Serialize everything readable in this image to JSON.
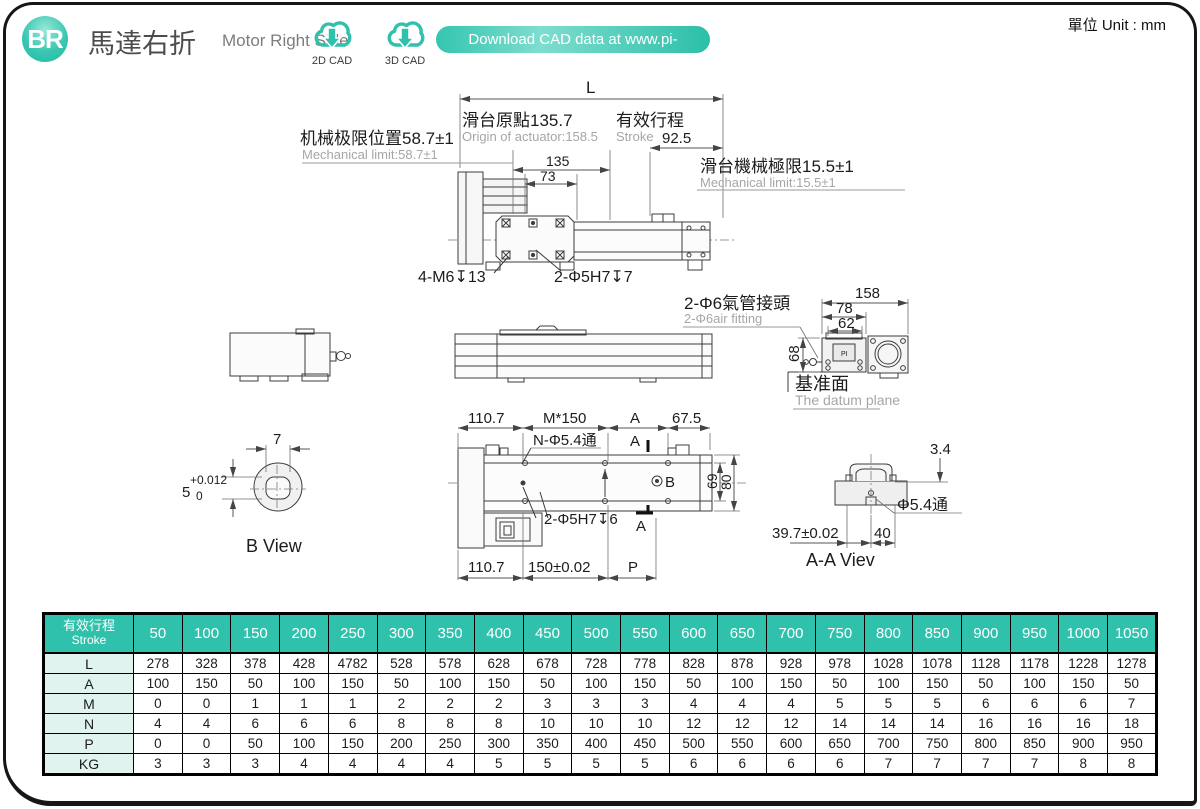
{
  "page": {
    "unit_label": "單位 Unit : mm"
  },
  "header": {
    "logo": "BR",
    "title_zh": "馬達右折",
    "title_en": "Motor Right Side",
    "cad_2d_label": "2D CAD",
    "cad_3d_label": "3D CAD",
    "download_label": "Download CAD data at www.pi-robot.com.cn"
  },
  "colors": {
    "brand_teal": "#2fc1ab",
    "table_label_bg": "#e0f3ef",
    "gray_text": "#a6a6a6"
  },
  "drawing": {
    "top": {
      "L": "L",
      "origin_zh": "滑台原點135.7",
      "origin_en": "Origin of actuator:158.5",
      "stroke_zh": "有效行程",
      "stroke_en": "Stroke",
      "stroke_val": "92.5",
      "lim_left_zh": "机械极限位置58.7±1",
      "lim_left_en": "Mechanical limit:58.7±1",
      "lim_right_zh": "滑台機械極限15.5±1",
      "lim_right_en": "Mechanical limit:15.5±1",
      "d135": "135",
      "d73": "73",
      "bolt": "4-M6↧13",
      "pin": "2-Φ5H7↧7"
    },
    "end": {
      "d158": "158",
      "d78": "78",
      "d62": "62",
      "d68": "68",
      "air_zh": "2-Φ6氣管接頭",
      "air_en": "2-Φ6air fitting",
      "datum_zh": "基准面",
      "datum_en": "The datum plane",
      "pi": "PI"
    },
    "bottom": {
      "d110a": "110.7",
      "dM": "M*150",
      "dA": "A",
      "d675": "67.5",
      "holes": "N-Φ5.4通",
      "secA_top": "A",
      "secA_bot": "A",
      "B": "B",
      "d69": "69",
      "d80": "80",
      "pin6": "2-Φ5H7↧6",
      "d110b": "110.7",
      "d150": "150±0.02",
      "dP": "P"
    },
    "bview": {
      "d7": "7",
      "d5": "5",
      "tol1": "+0.012",
      "tol2": "0",
      "cap": "B View"
    },
    "aaview": {
      "d34": "3.4",
      "phi": "Φ5.4通",
      "d397": "39.7±0.02",
      "d40": "40",
      "cap": "A-A Viev"
    }
  },
  "table": {
    "header_zh": "有效行程",
    "header_en": "Stroke",
    "strokes": [
      "50",
      "100",
      "150",
      "200",
      "250",
      "300",
      "350",
      "400",
      "450",
      "500",
      "550",
      "600",
      "650",
      "700",
      "750",
      "800",
      "850",
      "900",
      "950",
      "1000",
      "1050"
    ],
    "rows": [
      {
        "label": "L",
        "values": [
          "278",
          "328",
          "378",
          "428",
          "4782",
          "528",
          "578",
          "628",
          "678",
          "728",
          "778",
          "828",
          "878",
          "928",
          "978",
          "1028",
          "1078",
          "1128",
          "1178",
          "1228",
          "1278"
        ]
      },
      {
        "label": "A",
        "values": [
          "100",
          "150",
          "50",
          "100",
          "150",
          "50",
          "100",
          "150",
          "50",
          "100",
          "150",
          "50",
          "100",
          "150",
          "50",
          "100",
          "150",
          "50",
          "100",
          "150",
          "50"
        ]
      },
      {
        "label": "M",
        "values": [
          "0",
          "0",
          "1",
          "1",
          "1",
          "2",
          "2",
          "2",
          "3",
          "3",
          "3",
          "4",
          "4",
          "4",
          "5",
          "5",
          "5",
          "6",
          "6",
          "6",
          "7"
        ]
      },
      {
        "label": "N",
        "values": [
          "4",
          "4",
          "6",
          "6",
          "6",
          "8",
          "8",
          "8",
          "10",
          "10",
          "10",
          "12",
          "12",
          "12",
          "14",
          "14",
          "14",
          "16",
          "16",
          "16",
          "18"
        ]
      },
      {
        "label": "P",
        "values": [
          "0",
          "0",
          "50",
          "100",
          "150",
          "200",
          "250",
          "300",
          "350",
          "400",
          "450",
          "500",
          "550",
          "600",
          "650",
          "700",
          "750",
          "800",
          "850",
          "900",
          "950"
        ]
      },
      {
        "label": "KG",
        "values": [
          "3",
          "3",
          "3",
          "4",
          "4",
          "4",
          "4",
          "5",
          "5",
          "5",
          "5",
          "6",
          "6",
          "6",
          "6",
          "7",
          "7",
          "7",
          "7",
          "8",
          "8"
        ]
      }
    ]
  }
}
